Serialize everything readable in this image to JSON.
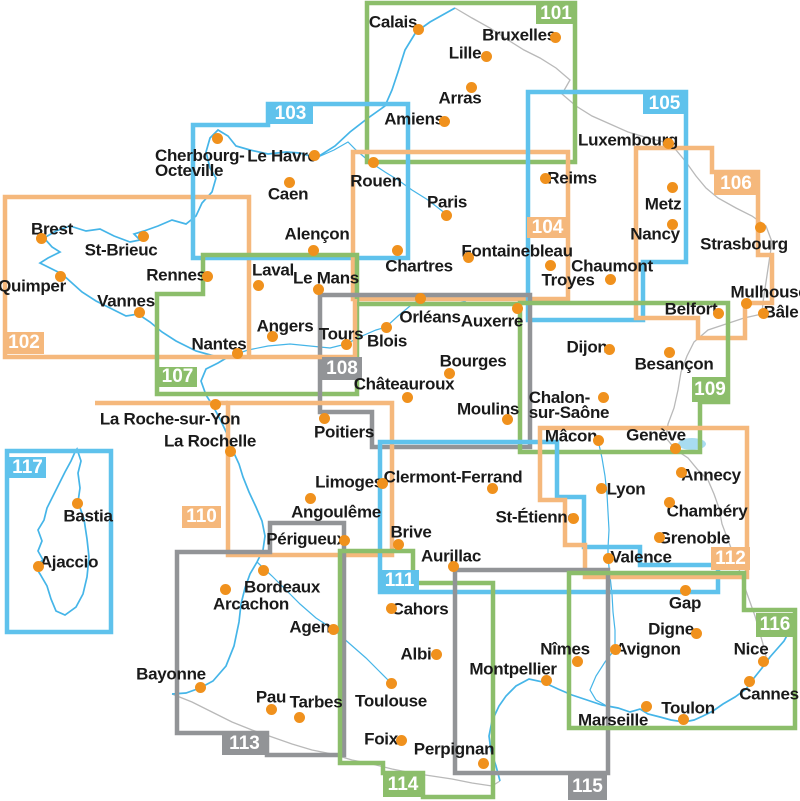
{
  "canvas": {
    "width": 800,
    "height": 801,
    "background": "#ffffff"
  },
  "palette": {
    "orange": "#F5B87C",
    "green": "#8CBE6B",
    "blue": "#5FC2EC",
    "gray": "#929497",
    "dot": "#F0911D",
    "text": "#1A1A1A",
    "coast": "#45B5E8",
    "river": "#45B5E8",
    "border": "#B9B9B9",
    "lake": "#A8DCF0",
    "sheet_label_text": "#FFFFFF"
  },
  "sheets": [
    {
      "id": "101",
      "color": "green",
      "path": "M367,3 L575,3 L575,162 L367,162 Z",
      "label": {
        "x": 536,
        "y": 3,
        "w": 40,
        "h": 21
      }
    },
    {
      "id": "102",
      "color": "orange",
      "path": "M5,197 L249,197 L249,357 L5,357 Z",
      "label": {
        "x": 4,
        "y": 332,
        "w": 40,
        "h": 22
      }
    },
    {
      "id": "103",
      "color": "blue",
      "path": "M193,125 L268,125 L268,104 L408,104 L408,258 L193,258 Z",
      "label": {
        "x": 268,
        "y": 104,
        "w": 45,
        "h": 20
      }
    },
    {
      "id": "104",
      "color": "orange",
      "path": "M353,152 L568,152 L568,299 L353,299 Z",
      "label": {
        "x": 527,
        "y": 217,
        "w": 41,
        "h": 21
      }
    },
    {
      "id": "105",
      "color": "blue",
      "path": "M528,92 L686,92 L686,262 L643,262 L643,320 L528,320 Z",
      "label": {
        "x": 643,
        "y": 93,
        "w": 43,
        "h": 21
      }
    },
    {
      "id": "106",
      "color": "orange",
      "path": "M636,148 L712,148 L712,172 L758,172 L758,255 L772,255 L772,303 L745,303 L745,338 L698,338 L698,318 L636,318 Z",
      "label": {
        "x": 714,
        "y": 172,
        "w": 44,
        "h": 23
      }
    },
    {
      "id": "107",
      "color": "green",
      "path": "M203,255 L357,255 L357,394 L157,394 L157,294 L203,294 Z",
      "label": {
        "x": 158,
        "y": 367,
        "w": 39,
        "h": 20
      }
    },
    {
      "id": "108",
      "color": "gray",
      "path": "M320,295 L530,295 L530,447 L372,447 L372,412 L320,412 Z",
      "label": {
        "x": 322,
        "y": 357,
        "w": 40,
        "h": 23
      }
    },
    {
      "id": "109",
      "color": "green",
      "path": "M520,303 L728,303 L728,402 L700,402 L700,452 L520,452 Z",
      "label": {
        "x": 692,
        "y": 377,
        "w": 36,
        "h": 25
      }
    },
    {
      "id": "110",
      "color": "orange",
      "path": "M228,403 L392,403 L392,555 L228,555 Z",
      "label": {
        "x": 182,
        "y": 506,
        "w": 39,
        "h": 22
      }
    },
    {
      "id": "111",
      "color": "blue",
      "path": "M380,442 L557,442 L557,497 L584,497 L584,547 L640,547 L640,565 L718,565 L718,592 L380,592 Z",
      "label": {
        "x": 380,
        "y": 570,
        "w": 39,
        "h": 22
      }
    },
    {
      "id": "112",
      "color": "orange",
      "path": "M540,428 L747,428 L747,577 L585,577 L585,545 L565,545 L565,500 L540,500 Z",
      "label": {
        "x": 711,
        "y": 547,
        "w": 39,
        "h": 23
      }
    },
    {
      "id": "113",
      "color": "gray",
      "path": "M270,523 L344,523 L344,755 L267,755 L267,733 L177,733 L177,552 L270,552 Z",
      "label": {
        "x": 222,
        "y": 733,
        "w": 45,
        "h": 22
      }
    },
    {
      "id": "114",
      "color": "green",
      "path": "M340,551 L413,551 L413,583 L493,583 L493,797 L423,797 L423,773 L383,773 L383,763 L340,763 Z",
      "label": {
        "x": 383,
        "y": 773,
        "w": 40,
        "h": 24
      }
    },
    {
      "id": "115",
      "color": "gray",
      "path": "M455,570 L608,570 L608,773 L455,773 Z",
      "label": {
        "x": 568,
        "y": 773,
        "w": 39,
        "h": 27
      }
    },
    {
      "id": "116",
      "color": "green",
      "path": "M569,573 L744,573 L744,610 L795,610 L795,728 L569,728 Z",
      "label": {
        "x": 756,
        "y": 613,
        "w": 38,
        "h": 24
      }
    },
    {
      "id": "117",
      "color": "blue",
      "path": "M7,451 L111,451 L111,632 L7,632 Z",
      "label": {
        "x": 9,
        "y": 457,
        "w": 37,
        "h": 21
      }
    }
  ],
  "extra_segments": [
    {
      "color": "orange",
      "path": "M355,299 L355,357 L249,357"
    },
    {
      "color": "orange",
      "path": "M228,403 L95,403"
    },
    {
      "color": "green",
      "path": "M357,304 L520,304"
    }
  ],
  "cities": [
    {
      "name": "Calais",
      "dot": [
        418,
        29
      ],
      "label": {
        "x": 393,
        "y": 22
      }
    },
    {
      "name": "Bruxelles",
      "dot": [
        555,
        37
      ],
      "label": {
        "x": 519,
        "y": 35
      }
    },
    {
      "name": "Lille",
      "dot": [
        486,
        56
      ],
      "label": {
        "x": 465,
        "y": 53
      }
    },
    {
      "name": "Arras",
      "dot": [
        471,
        87
      ],
      "label": {
        "x": 460,
        "y": 98
      }
    },
    {
      "name": "Amiens",
      "dot": [
        444,
        121
      ],
      "label": {
        "x": 414,
        "y": 119
      }
    },
    {
      "name": "Cherbourg-Octeville",
      "dot": [
        217,
        138
      ],
      "label": {
        "x": 155,
        "y": 163
      },
      "lines": [
        "Cherbourg-",
        "Octeville"
      ],
      "align": "left"
    },
    {
      "name": "Le Havre",
      "dot": [
        314,
        155
      ],
      "label": {
        "x": 282,
        "y": 156
      }
    },
    {
      "name": "Caen",
      "dot": [
        289,
        182
      ],
      "label": {
        "x": 288,
        "y": 194
      }
    },
    {
      "name": "Rouen",
      "dot": [
        373,
        162
      ],
      "label": {
        "x": 376,
        "y": 181
      }
    },
    {
      "name": "Reims",
      "dot": [
        545,
        178
      ],
      "label": {
        "x": 572,
        "y": 178
      }
    },
    {
      "name": "Luxembourg",
      "dot": [
        668,
        143
      ],
      "label": {
        "x": 628,
        "y": 140
      }
    },
    {
      "name": "Metz",
      "dot": [
        672,
        187
      ],
      "label": {
        "x": 663,
        "y": 204
      }
    },
    {
      "name": "Nancy",
      "dot": [
        672,
        224
      ],
      "label": {
        "x": 655,
        "y": 234
      }
    },
    {
      "name": "Strasbourg",
      "dot": [
        760,
        227
      ],
      "label": {
        "x": 744,
        "y": 244
      }
    },
    {
      "name": "Mulhouse",
      "dot": [
        746,
        303
      ],
      "label": {
        "x": 769,
        "y": 292
      }
    },
    {
      "name": "Bâle",
      "dot": [
        763,
        313
      ],
      "label": {
        "x": 781,
        "y": 312
      }
    },
    {
      "name": "Belfort",
      "dot": [
        718,
        313
      ],
      "label": {
        "x": 691,
        "y": 309
      }
    },
    {
      "name": "Chaumont",
      "dot": [
        610,
        279
      ],
      "label": {
        "x": 612,
        "y": 266
      }
    },
    {
      "name": "Troyes",
      "dot": [
        550,
        265
      ],
      "label": {
        "x": 568,
        "y": 280
      }
    },
    {
      "name": "Paris",
      "dot": [
        446,
        215
      ],
      "label": {
        "x": 447,
        "y": 202
      }
    },
    {
      "name": "Chartres",
      "dot": [
        397,
        250
      ],
      "label": {
        "x": 419,
        "y": 266
      }
    },
    {
      "name": "Fontainebleau",
      "dot": [
        468,
        257
      ],
      "label": {
        "x": 517,
        "y": 251
      }
    },
    {
      "name": "Alençon",
      "dot": [
        313,
        250
      ],
      "label": {
        "x": 317,
        "y": 234
      }
    },
    {
      "name": "Laval",
      "dot": [
        258,
        285
      ],
      "label": {
        "x": 273,
        "y": 270
      }
    },
    {
      "name": "Le Mans",
      "dot": [
        318,
        289
      ],
      "label": {
        "x": 326,
        "y": 278
      }
    },
    {
      "name": "Rennes",
      "dot": [
        207,
        276
      ],
      "label": {
        "x": 176,
        "y": 275
      }
    },
    {
      "name": "Brest",
      "dot": [
        41,
        238
      ],
      "label": {
        "x": 52,
        "y": 229
      }
    },
    {
      "name": "St-Brieuc",
      "dot": [
        143,
        236
      ],
      "label": {
        "x": 121,
        "y": 250
      }
    },
    {
      "name": "Quimper",
      "dot": [
        60,
        276
      ],
      "label": {
        "x": 32,
        "y": 286
      }
    },
    {
      "name": "Vannes",
      "dot": [
        139,
        312
      ],
      "label": {
        "x": 126,
        "y": 301
      }
    },
    {
      "name": "Nantes",
      "dot": [
        237,
        353
      ],
      "label": {
        "x": 219,
        "y": 344
      }
    },
    {
      "name": "Angers",
      "dot": [
        272,
        336
      ],
      "label": {
        "x": 285,
        "y": 326
      }
    },
    {
      "name": "Tours",
      "dot": [
        346,
        344
      ],
      "label": {
        "x": 341,
        "y": 334
      }
    },
    {
      "name": "Blois",
      "dot": [
        386,
        327
      ],
      "label": {
        "x": 387,
        "y": 341
      }
    },
    {
      "name": "Orléans",
      "dot": [
        420,
        298
      ],
      "label": {
        "x": 430,
        "y": 317
      }
    },
    {
      "name": "Auxerre",
      "dot": [
        517,
        308
      ],
      "label": {
        "x": 492,
        "y": 321
      }
    },
    {
      "name": "Bourges",
      "dot": [
        449,
        373
      ],
      "label": {
        "x": 473,
        "y": 361
      }
    },
    {
      "name": "Châteauroux",
      "dot": [
        407,
        397
      ],
      "label": {
        "x": 404,
        "y": 384
      }
    },
    {
      "name": "Moulins",
      "dot": [
        507,
        419
      ],
      "label": {
        "x": 488,
        "y": 409
      }
    },
    {
      "name": "Dijon",
      "dot": [
        609,
        349
      ],
      "label": {
        "x": 587,
        "y": 347
      }
    },
    {
      "name": "Besançon",
      "dot": [
        669,
        352
      ],
      "label": {
        "x": 674,
        "y": 364
      }
    },
    {
      "name": "Chalon-sur-Saône",
      "dot": [
        603,
        397
      ],
      "label": {
        "x": 569,
        "y": 405
      },
      "lines": [
        "Chalon-",
        "sur-Saône"
      ]
    },
    {
      "name": "Mâcon",
      "dot": [
        598,
        440
      ],
      "label": {
        "x": 571,
        "y": 436
      }
    },
    {
      "name": "Genève",
      "dot": [
        675,
        448
      ],
      "label": {
        "x": 656,
        "y": 435
      }
    },
    {
      "name": "La Roche-sur-Yon",
      "dot": [
        215,
        404
      ],
      "label": {
        "x": 170,
        "y": 419
      }
    },
    {
      "name": "La Rochelle",
      "dot": [
        230,
        451
      ],
      "label": {
        "x": 210,
        "y": 441
      }
    },
    {
      "name": "Poitiers",
      "dot": [
        324,
        418
      ],
      "label": {
        "x": 344,
        "y": 432
      }
    },
    {
      "name": "Limoges",
      "dot": [
        382,
        483
      ],
      "label": {
        "x": 349,
        "y": 482
      }
    },
    {
      "name": "Angoulême",
      "dot": [
        310,
        498
      ],
      "label": {
        "x": 336,
        "y": 512
      }
    },
    {
      "name": "Périgueux",
      "dot": [
        344,
        540
      ],
      "label": {
        "x": 306,
        "y": 539
      }
    },
    {
      "name": "Clermont-Ferrand",
      "dot": [
        492,
        488
      ],
      "label": {
        "x": 453,
        "y": 477
      }
    },
    {
      "name": "St-Étienne",
      "dot": [
        573,
        518
      ],
      "label": {
        "x": 536,
        "y": 517
      }
    },
    {
      "name": "Lyon",
      "dot": [
        601,
        488
      ],
      "label": {
        "x": 626,
        "y": 489
      }
    },
    {
      "name": "Annecy",
      "dot": [
        681,
        472
      ],
      "label": {
        "x": 711,
        "y": 475
      }
    },
    {
      "name": "Chambéry",
      "dot": [
        669,
        502
      ],
      "label": {
        "x": 707,
        "y": 511
      }
    },
    {
      "name": "Grenoble",
      "dot": [
        659,
        537
      ],
      "label": {
        "x": 694,
        "y": 538
      }
    },
    {
      "name": "Valence",
      "dot": [
        608,
        558
      ],
      "label": {
        "x": 641,
        "y": 557
      }
    },
    {
      "name": "Gap",
      "dot": [
        685,
        590
      ],
      "label": {
        "x": 685,
        "y": 603
      }
    },
    {
      "name": "Digne",
      "dot": [
        696,
        633
      ],
      "label": {
        "x": 671,
        "y": 629
      }
    },
    {
      "name": "Avignon",
      "dot": [
        615,
        649
      ],
      "label": {
        "x": 648,
        "y": 649
      }
    },
    {
      "name": "Nîmes",
      "dot": [
        577,
        661
      ],
      "label": {
        "x": 565,
        "y": 649
      }
    },
    {
      "name": "Montpellier",
      "dot": [
        546,
        680
      ],
      "label": {
        "x": 513,
        "y": 669
      }
    },
    {
      "name": "Brive",
      "dot": [
        398,
        544
      ],
      "label": {
        "x": 411,
        "y": 532
      }
    },
    {
      "name": "Aurillac",
      "dot": [
        453,
        566
      ],
      "label": {
        "x": 451,
        "y": 556
      }
    },
    {
      "name": "Cahors",
      "dot": [
        391,
        608
      ],
      "label": {
        "x": 420,
        "y": 609
      }
    },
    {
      "name": "Bordeaux",
      "dot": [
        263,
        570
      ],
      "label": {
        "x": 282,
        "y": 587
      }
    },
    {
      "name": "Arcachon",
      "dot": [
        225,
        589
      ],
      "label": {
        "x": 251,
        "y": 604
      }
    },
    {
      "name": "Agen",
      "dot": [
        333,
        629
      ],
      "label": {
        "x": 310,
        "y": 627
      }
    },
    {
      "name": "Bayonne",
      "dot": [
        200,
        687
      ],
      "label": {
        "x": 171,
        "y": 674
      }
    },
    {
      "name": "Pau",
      "dot": [
        271,
        709
      ],
      "label": {
        "x": 271,
        "y": 697
      }
    },
    {
      "name": "Tarbes",
      "dot": [
        299,
        717
      ],
      "label": {
        "x": 316,
        "y": 702
      }
    },
    {
      "name": "Toulouse",
      "dot": [
        391,
        683
      ],
      "label": {
        "x": 391,
        "y": 701
      }
    },
    {
      "name": "Albi",
      "dot": [
        436,
        654
      ],
      "label": {
        "x": 416,
        "y": 654
      }
    },
    {
      "name": "Foix",
      "dot": [
        401,
        740
      ],
      "label": {
        "x": 381,
        "y": 739
      }
    },
    {
      "name": "Perpignan",
      "dot": [
        483,
        763
      ],
      "label": {
        "x": 454,
        "y": 749
      }
    },
    {
      "name": "Marseille",
      "dot": [
        646,
        706
      ],
      "label": {
        "x": 613,
        "y": 720
      }
    },
    {
      "name": "Toulon",
      "dot": [
        683,
        719
      ],
      "label": {
        "x": 688,
        "y": 708
      }
    },
    {
      "name": "Nice",
      "dot": [
        763,
        661
      ],
      "label": {
        "x": 751,
        "y": 649
      }
    },
    {
      "name": "Cannes",
      "dot": [
        749,
        681
      ],
      "label": {
        "x": 769,
        "y": 694
      }
    },
    {
      "name": "Bastia",
      "dot": [
        77,
        503
      ],
      "label": {
        "x": 88,
        "y": 516
      }
    },
    {
      "name": "Ajaccio",
      "dot": [
        38,
        566
      ],
      "label": {
        "x": 69,
        "y": 562
      }
    }
  ],
  "geo": {
    "coast": [
      "M455,8 L430,22 L416,32 L405,50 L398,72 L392,90 L385,106 L368,118 L350,132 L335,146 L316,158 L300,153 L286,152 L268,154 L250,150 L236,146 L228,136 L218,130 L210,138 L206,152 L210,168 L216,178 L212,192 L202,203 L196,216 L186,224 L172,220 L158,226 L144,231 L134,234 L140,240 L130,242 L114,236 L100,229 L86,231 L70,226 L56,231 L44,238 L52,247 L60,252 L48,258 L40,263 L52,269 L62,274 L72,283 L82,292 L96,301 L112,309 L126,316 L138,314 L150,322 L162,332 L176,341 L196,351 L214,356 L228,357 L218,363 L206,369 L201,381 L206,395 L213,406 L221,421 L228,436 L233,451 L239,464 L243,477 L249,492 L256,507 L262,521 L265,536 L263,550 L257,562 L250,574 L245,588 L241,604 L239,622 L234,646 L226,666 L213,681 L200,688 L186,693 L172,694",
      "M500,781 L496,766 L491,751 L489,736 L492,721 L499,706 L506,696 L516,686 L529,679 L543,682 L558,689 L572,695 L587,700 L602,705 L618,708 L630,712 L640,709 L648,714 L660,717 L671,720 L684,722 L694,720 L703,716 L713,711 L723,704 L735,697 L746,689 L754,678 L762,668 L770,657 L777,649 L784,641 L790,630 L794,617 L795,611"
    ],
    "corsica": "M77,449 L81,461 L78,473 L80,488 L78,502 L84,519 L87,539 L89,557 L87,577 L83,594 L76,607 L65,615 L56,611 L51,599 L47,586 L40,574 L35,566 L43,560 L38,551 L42,541 L38,530 L44,520 L47,508 L53,496 L59,484 L65,472 L71,461 L75,452 Z",
    "borders": [
      "M455,8 L472,18 L490,28 L508,40 L524,50 L540,58 L556,68 L570,80 L562,94 L576,106 L592,116 L610,124 L628,132 L648,138 L664,142 L676,150 L686,162 L696,176 L706,188 L718,198 L736,208 L752,216 L766,226 L772,242 L769,262 L766,282 L763,302 L762,314 L744,318 L726,324 L708,330 L694,342 L687,356 L681,372 L678,390 L674,408 L668,424 L666,438 L676,450 L688,458 L698,470 L708,480 L714,494 L719,508 L722,524 L728,540 L734,556 L740,572 L745,588 L750,602 L755,616 L759,630 L763,644 L766,656 L762,668",
      "M172,694 L192,702 L212,712 L232,722 L252,730 L272,737 L292,744 L312,750 L332,754 L352,760 L372,764 L392,769 L412,773 L432,776 L452,779 L472,783 L492,786 L500,781"
    ],
    "rivers": [
      "M316,158 L334,150 L348,142 L356,150 L370,162 L385,172 L398,180 L412,190 L428,200 L446,214",
      "M228,357 L248,350 L268,346 L290,344 L310,346 L330,348 L346,344 L362,336 L376,330 L386,327 L398,316 L410,306 L420,299 L436,296 L452,298 L466,302",
      "M257,562 L272,576 L286,590 L300,604 L316,618 L333,629 L350,644 L366,658 L378,670 L391,683",
      "M598,440 L602,458 L605,476 L607,494 L608,512 L609,530 L608,548 L608,558 L610,576 L612,594 L613,612 L615,630 L615,649 L605,662 L596,676 L590,690 L596,700 L605,705"
    ],
    "lake": {
      "cx": 692,
      "cy": 444,
      "rx": 14,
      "ry": 6
    }
  }
}
